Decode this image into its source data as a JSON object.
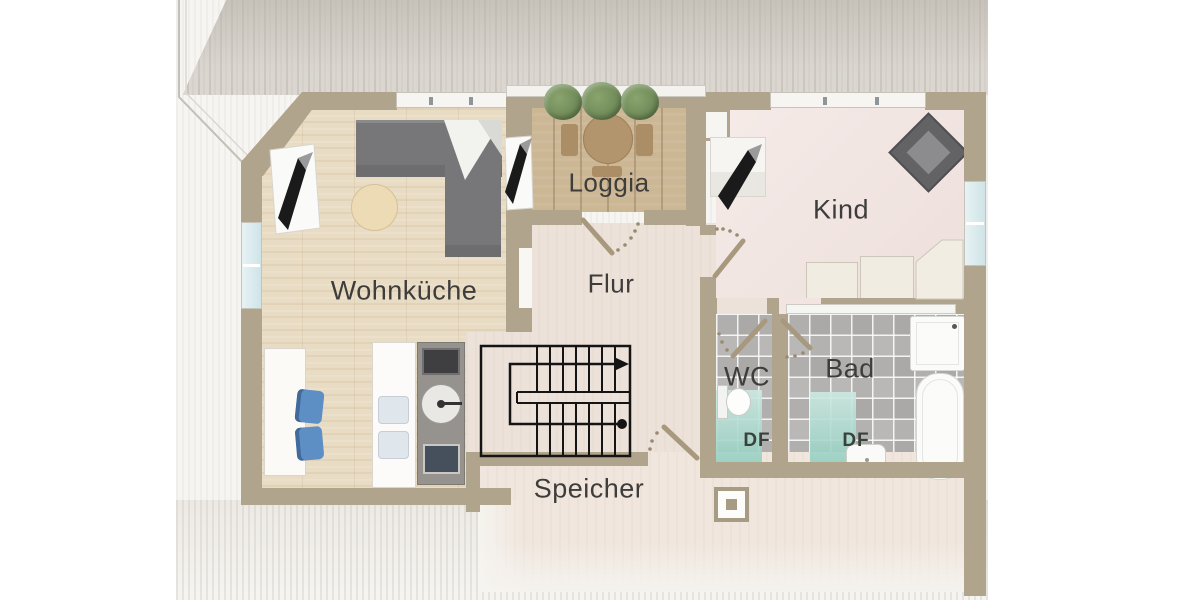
{
  "plan_title": "Dachgeschoss Grundriss",
  "rooms": [
    {
      "id": "wohnkueche",
      "label": "Wohnküche"
    },
    {
      "id": "loggia",
      "label": "Loggia"
    },
    {
      "id": "flur",
      "label": "Flur"
    },
    {
      "id": "kind",
      "label": "Kind"
    },
    {
      "id": "wc",
      "label": "WC"
    },
    {
      "id": "bad",
      "label": "Bad"
    },
    {
      "id": "speicher",
      "label": "Speicher"
    }
  ],
  "skylights": {
    "wc_label": "DF",
    "bad_label": "DF"
  },
  "colors": {
    "wall": "#b1a48c",
    "wood_floor": "#e9dcc4",
    "loggia_floor": "#ccb795",
    "hall_floor": "#ece2d9",
    "kind_floor": "#f2e4e0",
    "tile_floor": "#b3b2b0",
    "skylight_teal": "#96cfc2",
    "stair_line": "#141414",
    "label_text": "#3e3d3b"
  }
}
